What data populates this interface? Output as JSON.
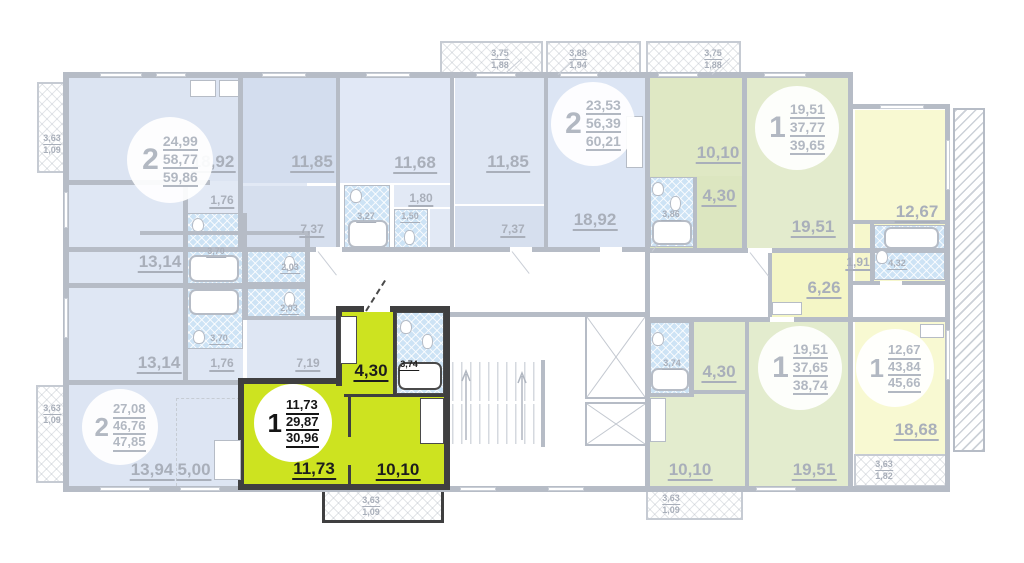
{
  "colors": {
    "highlight": "#cde320",
    "highlight_wall": "#3f3f40",
    "blue_room": "#dce4f2",
    "green_room": "#e1e9c9",
    "yellow_room": "#f8f9d2",
    "bath_tile": "#cde3f5",
    "wall": "#b6bcc6",
    "label_text": "#a9afba",
    "label_text_selected": "#1d1d1d"
  },
  "badges": [
    {
      "rooms": "2",
      "a1": "24,99",
      "a2": "58,77",
      "a3": "59,86"
    },
    {
      "rooms": "2",
      "a1": "23,53",
      "a2": "56,39",
      "a3": "60,21"
    },
    {
      "rooms": "1",
      "a1": "19,51",
      "a2": "37,77",
      "a3": "39,65"
    },
    {
      "rooms": "2",
      "a1": "27,08",
      "a2": "46,76",
      "a3": "47,85"
    },
    {
      "rooms": "1",
      "a1": "11,73",
      "a2": "29,87",
      "a3": "30,96"
    },
    {
      "rooms": "1",
      "a1": "19,51",
      "a2": "37,65",
      "a3": "38,74"
    },
    {
      "rooms": "1",
      "a1": "12,67",
      "a2": "43,84",
      "a3": "45,66"
    }
  ],
  "rooms": {
    "r1892a": "18,92",
    "r1185a": "11,85",
    "r1168": "11,68",
    "r1185b": "11,85",
    "r176a": "1,76",
    "r737a": "7,37",
    "r327": "3,27",
    "r150": "1,50",
    "r180": "1,80",
    "r737b": "7,37",
    "r1892b": "18,92",
    "r1314a": "13,14",
    "r370a": "3,70",
    "r203a": "2,03",
    "r203b": "2,03",
    "r370b": "3,70",
    "r1314b": "13,14",
    "r176b": "1,76",
    "r719": "7,19",
    "r1394": "13,94",
    "r500": "5,00",
    "r1010tr": "10,10",
    "r430tr": "4,30",
    "r386": "3,86",
    "r1951tr": "19,51",
    "r1267": "12,67",
    "r191": "1,91",
    "r432": "4,32",
    "r626": "6,26",
    "r374g": "3,74",
    "r430g": "4,30",
    "r1010g": "10,10",
    "r1951g": "19,51",
    "r1868": "18,68",
    "h430": "4,30",
    "h374": "3,74",
    "h1173": "11,73",
    "h1010": "10,10"
  },
  "balconies": {
    "leftTop": {
      "l1": "3,63",
      "l2": "1,09"
    },
    "leftBottom": {
      "l1": "3,63",
      "l2": "1,09"
    },
    "top1": {
      "l1": "3,75",
      "l2": "1,88"
    },
    "top2": {
      "l1": "3,88",
      "l2": "1,94"
    },
    "top3": {
      "l1": "3,75",
      "l2": "1,88"
    },
    "hl": {
      "l1": "3,63",
      "l2": "1,09"
    },
    "green": {
      "l1": "3,63",
      "l2": "1,09"
    },
    "yellow": {
      "l1": "3,63",
      "l2": "1,82"
    }
  }
}
